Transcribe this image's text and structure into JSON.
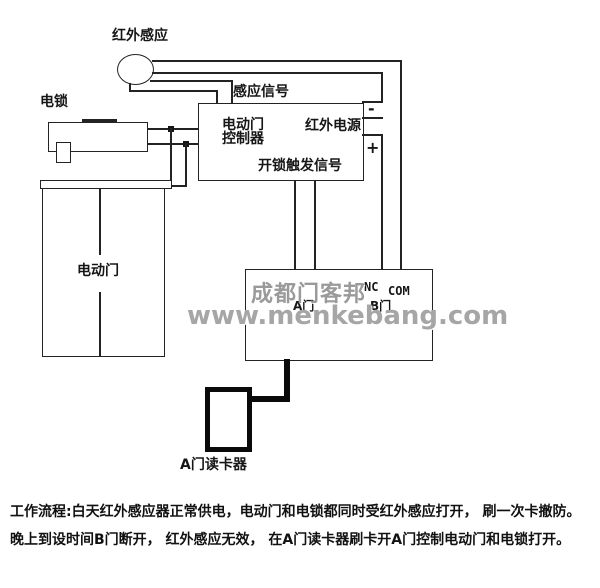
{
  "diagram": {
    "title_note": "电动门/读卡器接线示意图",
    "colors": {
      "line": "#232323",
      "watermark": "#9a9a9a",
      "background": "#ffffff"
    },
    "labels": {
      "sensor": "红外感应",
      "lock": "电锁",
      "signal": "感应信号",
      "controller_line1": "电动门",
      "controller_line2": "控制器",
      "power": "红外电源",
      "trigger": "开锁触发信号",
      "minus": "-",
      "plus": "+",
      "door": "电动门",
      "nc": "NC",
      "com": "COM",
      "door_b": "B门",
      "door_a": "A门",
      "reader": "A门读卡器"
    },
    "watermark": {
      "cn": "成都门客邦",
      "url": "www.menkebang.com"
    },
    "flow_text": {
      "line1": "工作流程:白天红外感应器正常供电，电动门和电锁都同时受红外感应打开， 刷一次卡撤防。",
      "line2": "晚上到设时间B门断开， 红外感应无效， 在A门读卡器刷卡开A门控制电动门和电锁打开。"
    }
  }
}
